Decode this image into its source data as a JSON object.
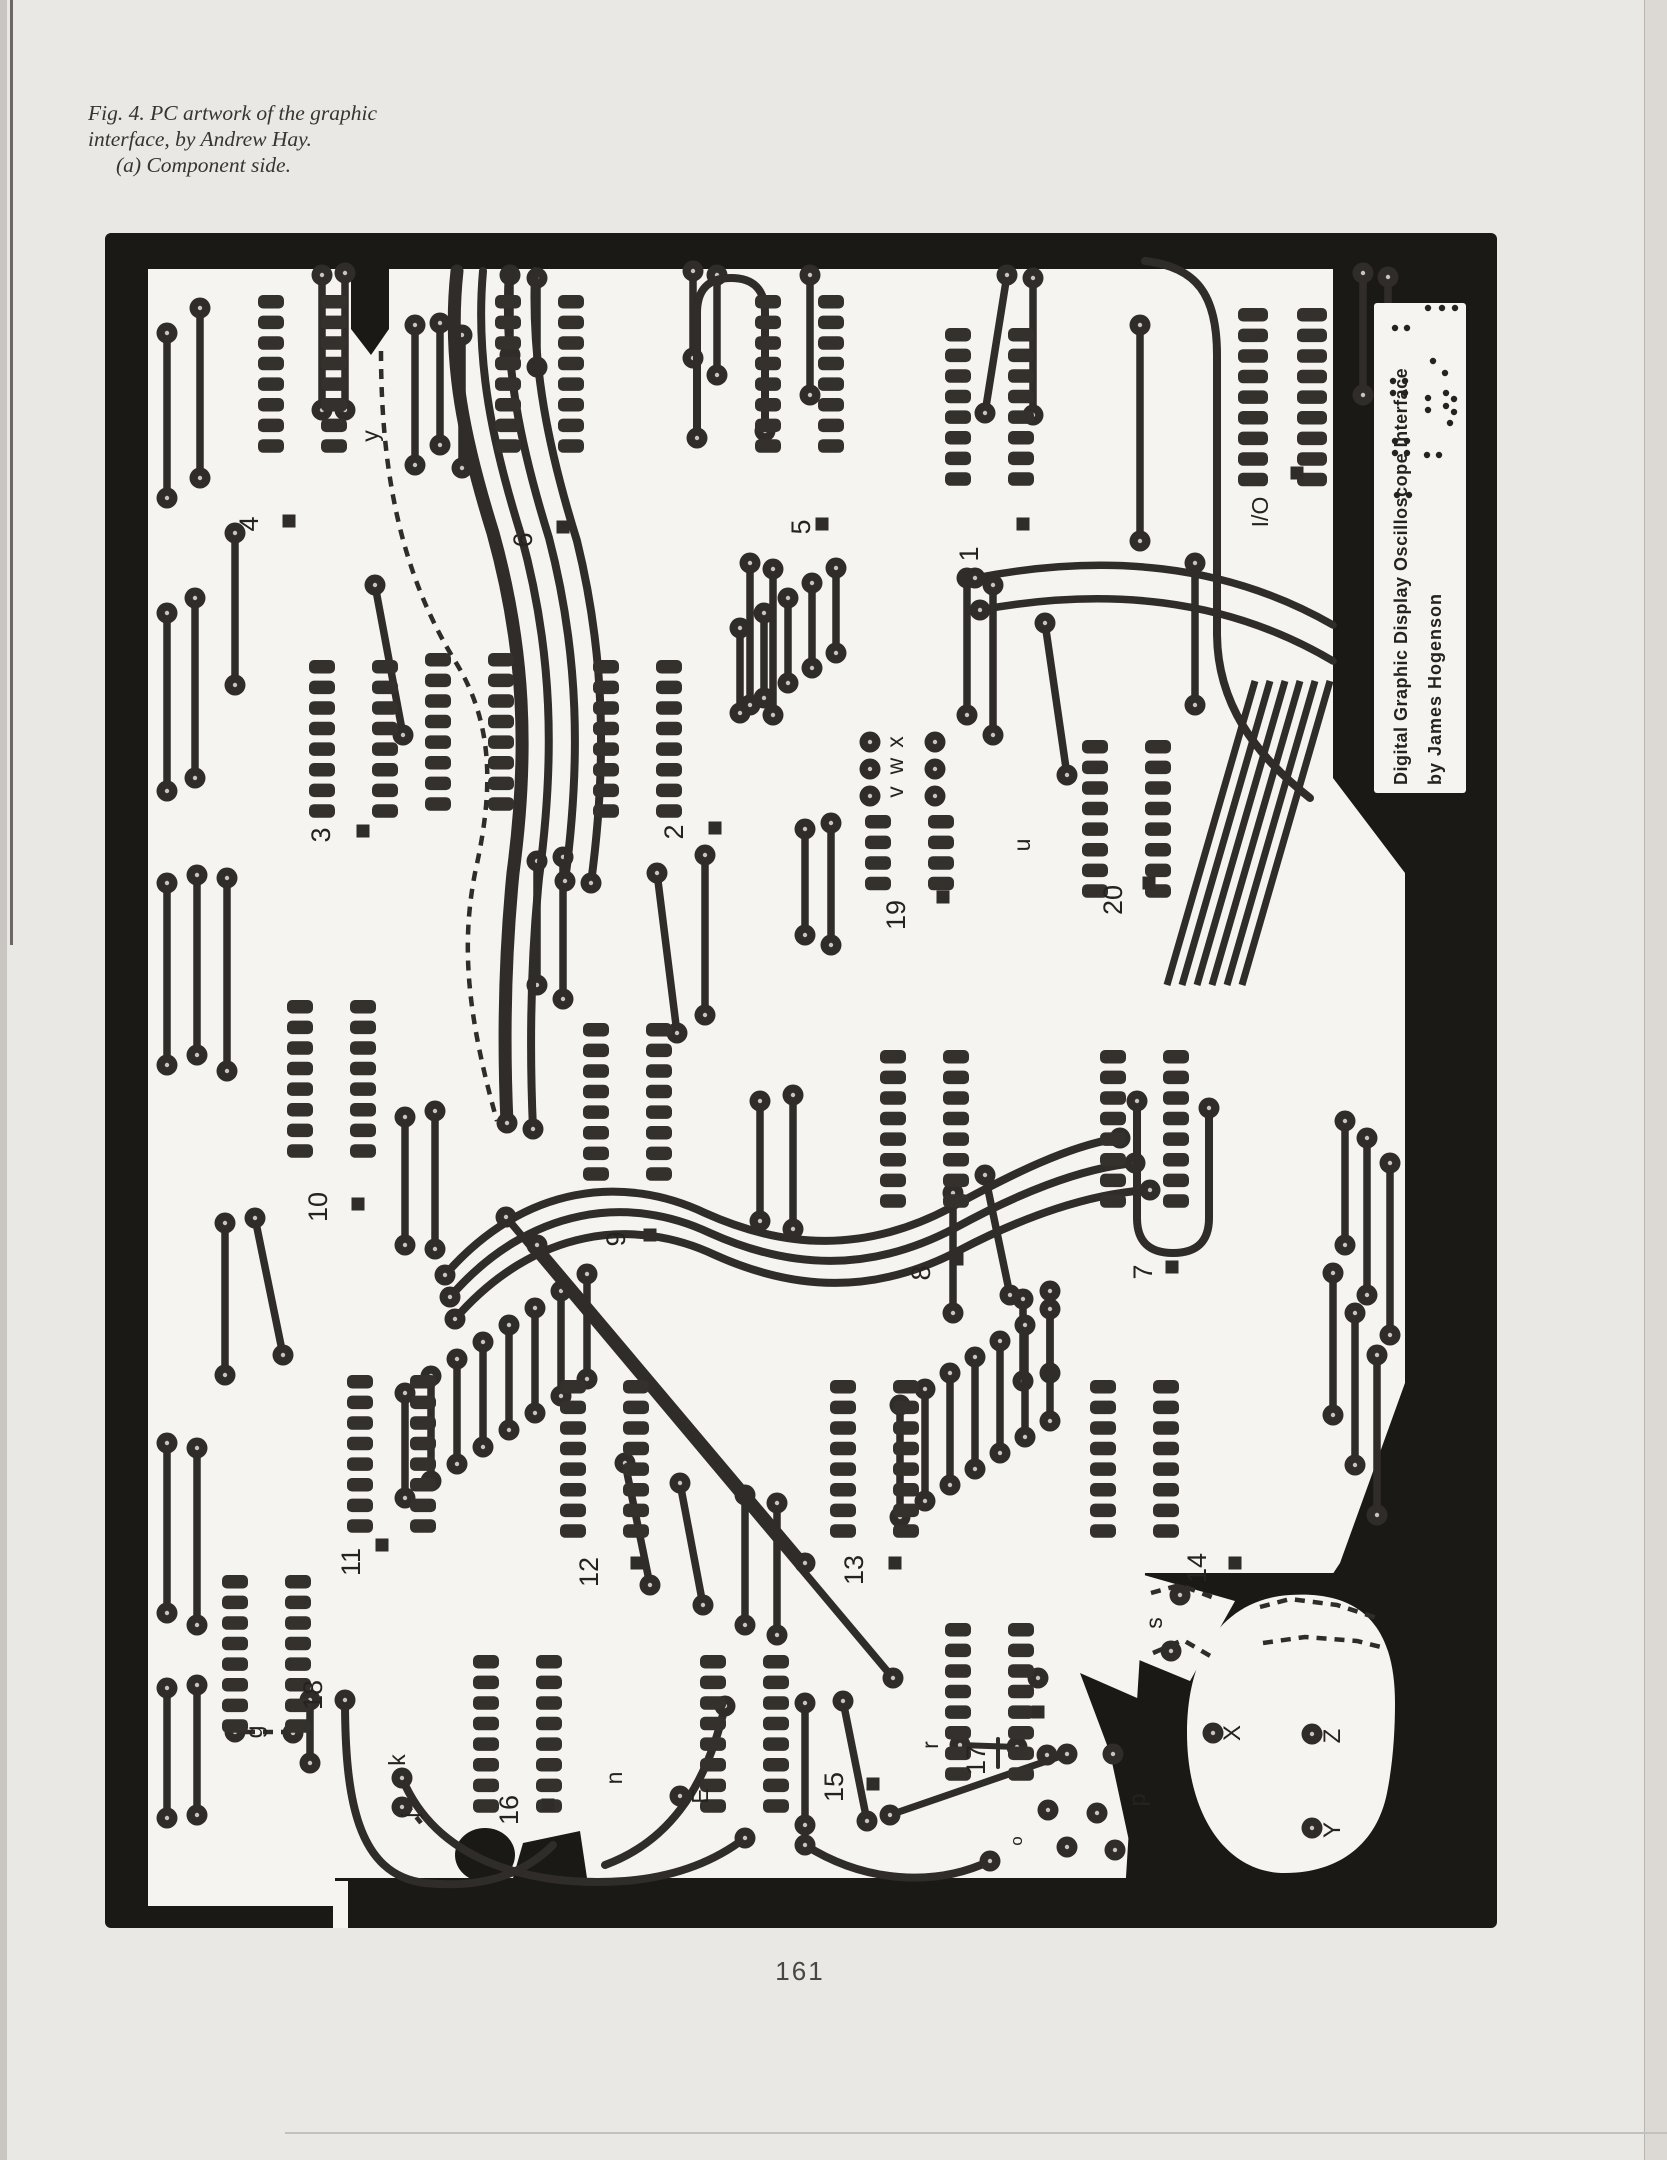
{
  "page": {
    "caption_line1": "Fig. 4. PC artwork of the graphic",
    "caption_line2": "interface, by Andrew Hay.",
    "caption_line3": "(a) Component side.",
    "page_number": "161"
  },
  "figure": {
    "title_line1": "Digital Graphic Display Oscilloscope Interface",
    "title_line2": "by  James  Hogenson",
    "board_labels": [
      {
        "text": "4",
        "x": 153,
        "y": 291,
        "size": 27
      },
      {
        "text": "6",
        "x": 427,
        "y": 307,
        "size": 27
      },
      {
        "text": "5",
        "x": 705,
        "y": 294,
        "size": 27
      },
      {
        "text": "1",
        "x": 873,
        "y": 321,
        "size": 27
      },
      {
        "text": "I/O",
        "x": 1163,
        "y": 279,
        "size": 23
      },
      {
        "text": "3",
        "x": 225,
        "y": 602,
        "size": 27
      },
      {
        "text": "2",
        "x": 578,
        "y": 599,
        "size": 27
      },
      {
        "text": "19",
        "x": 800,
        "y": 682,
        "size": 27
      },
      {
        "text": "20",
        "x": 1017,
        "y": 667,
        "size": 27
      },
      {
        "text": "10",
        "x": 222,
        "y": 974,
        "size": 27
      },
      {
        "text": "9",
        "x": 520,
        "y": 1006,
        "size": 27
      },
      {
        "text": "8",
        "x": 825,
        "y": 1040,
        "size": 27
      },
      {
        "text": "7",
        "x": 1047,
        "y": 1039,
        "size": 27
      },
      {
        "text": "11",
        "x": 255,
        "y": 1329,
        "size": 27
      },
      {
        "text": "12",
        "x": 493,
        "y": 1339,
        "size": 27
      },
      {
        "text": "13",
        "x": 758,
        "y": 1337,
        "size": 27
      },
      {
        "text": "14",
        "x": 1101,
        "y": 1335,
        "size": 27
      },
      {
        "text": "18",
        "x": 217,
        "y": 1462,
        "size": 27
      },
      {
        "text": "16",
        "x": 413,
        "y": 1577,
        "size": 27
      },
      {
        "text": "15",
        "x": 738,
        "y": 1554,
        "size": 27
      },
      {
        "text": "17",
        "x": 880,
        "y": 1527,
        "size": 27
      },
      {
        "text": "y",
        "x": 273,
        "y": 203,
        "size": 23
      },
      {
        "text": "x",
        "x": 798,
        "y": 509,
        "size": 23
      },
      {
        "text": "w",
        "x": 798,
        "y": 533,
        "size": 23
      },
      {
        "text": "v",
        "x": 798,
        "y": 559,
        "size": 23
      },
      {
        "text": "u",
        "x": 925,
        "y": 612,
        "size": 23
      },
      {
        "text": "g",
        "x": 157,
        "y": 1499,
        "size": 23
      },
      {
        "text": "k",
        "x": 300,
        "y": 1527,
        "size": 23
      },
      {
        "text": "j",
        "x": 313,
        "y": 1582,
        "size": 23
      },
      {
        "text": "n",
        "x": 517,
        "y": 1545,
        "size": 23
      },
      {
        "text": "E",
        "x": 603,
        "y": 1563,
        "size": 23
      },
      {
        "text": "r",
        "x": 833,
        "y": 1512,
        "size": 23
      },
      {
        "text": "o",
        "x": 917,
        "y": 1608,
        "size": 17
      },
      {
        "text": "p",
        "x": 1040,
        "y": 1567,
        "size": 23
      },
      {
        "text": "s",
        "x": 1057,
        "y": 1390,
        "size": 23
      },
      {
        "text": "X",
        "x": 1135,
        "y": 1500,
        "size": 24
      },
      {
        "text": "Z",
        "x": 1235,
        "y": 1503,
        "size": 24
      },
      {
        "text": "Y",
        "x": 1235,
        "y": 1597,
        "size": 24
      }
    ]
  }
}
